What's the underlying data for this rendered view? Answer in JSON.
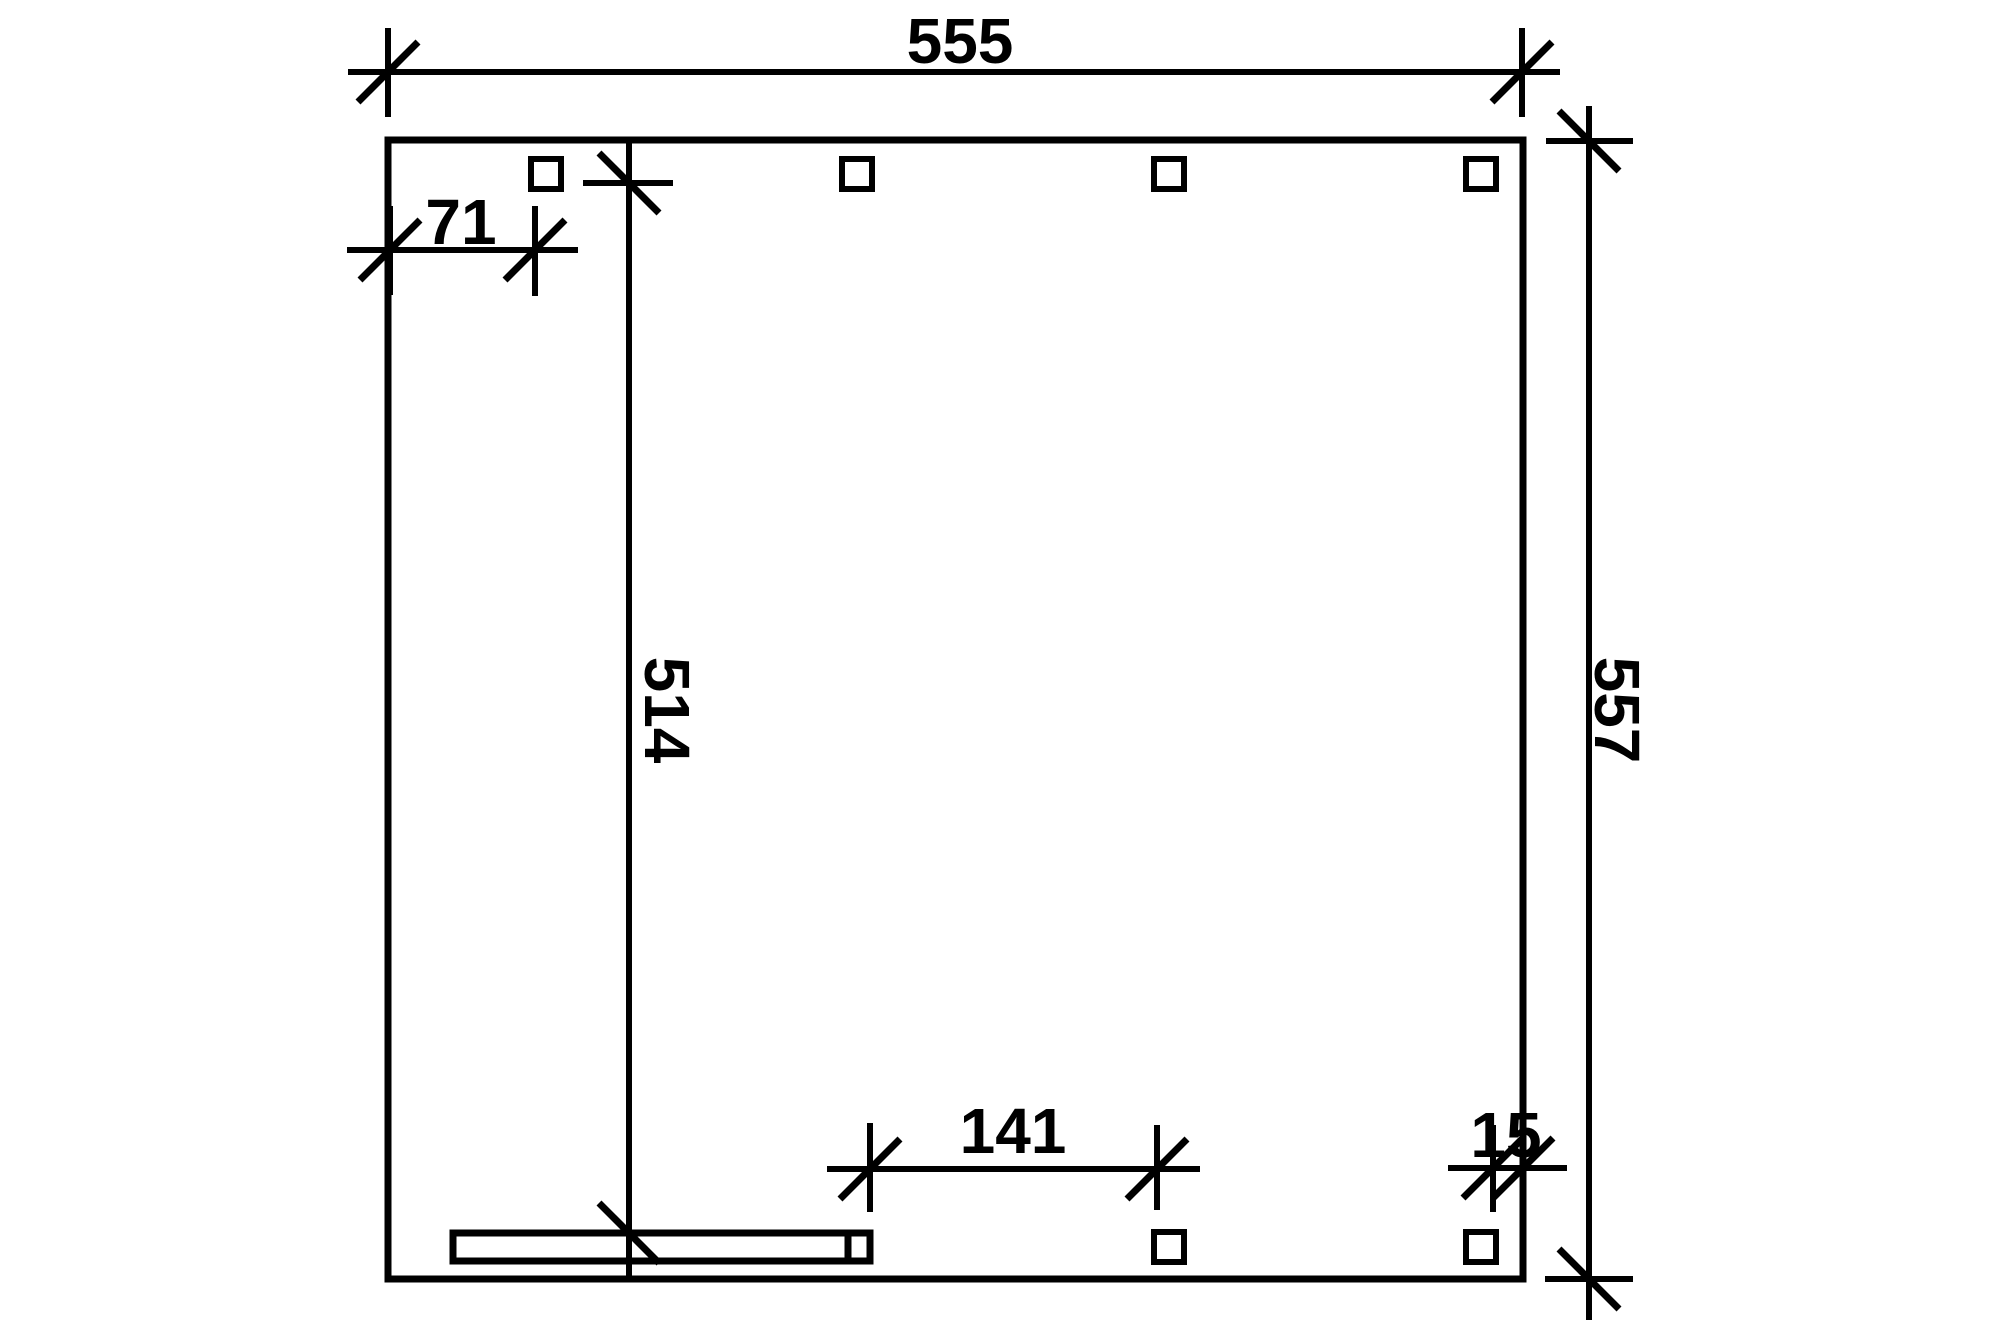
{
  "page": {
    "background_color": "#ffffff",
    "line_color": "#000000"
  },
  "drawing": {
    "kind": "technical plan view with dimension lines",
    "units_shown": false,
    "labels": {
      "total_width": "555",
      "left_offset": "71",
      "inner_length": "514",
      "total_height": "557",
      "post_spacing": "141",
      "edge_offset": "15"
    },
    "posts": {
      "top_row_count": 4,
      "bottom_row_count": 2,
      "bar_end_post_count": 1
    }
  }
}
